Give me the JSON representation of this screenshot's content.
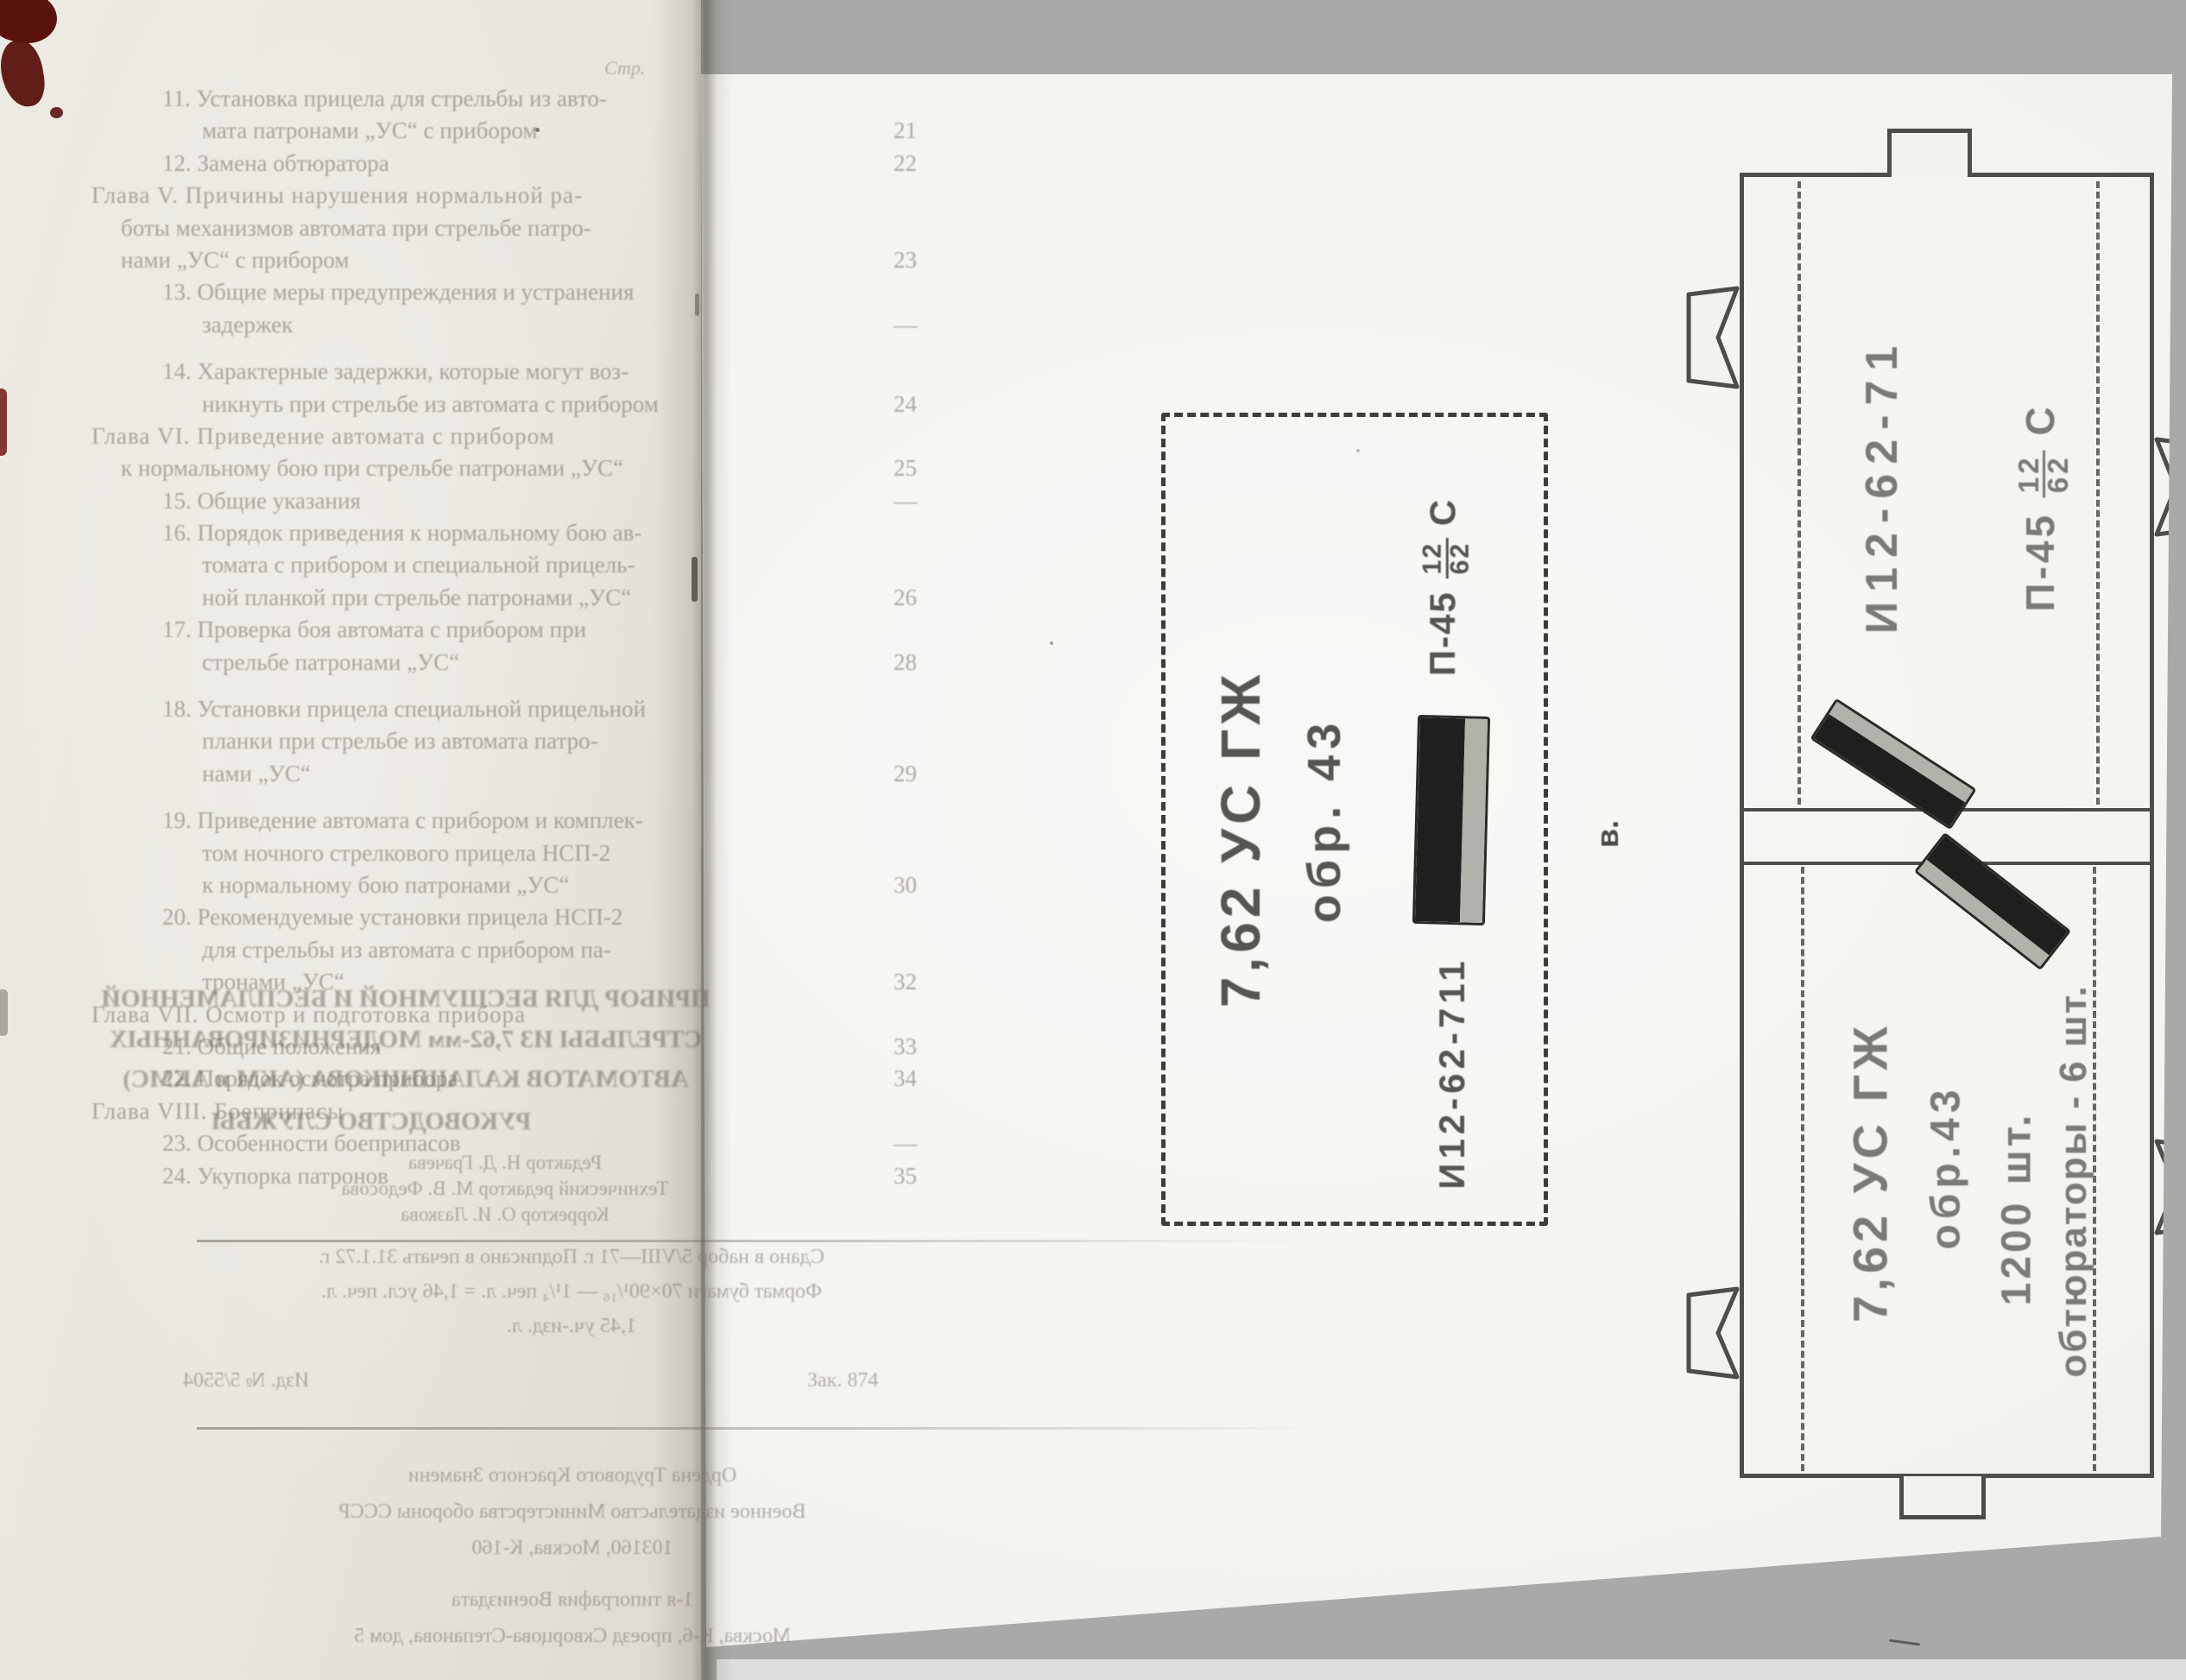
{
  "colors": {
    "scan_bg": "#a9a9a7",
    "paper_left": "#eae7e0",
    "paper_sheet": "#f3f2ee",
    "ink_line": "#4e4d49",
    "stamp_dark": "#565550",
    "stamp_gray": "#7b7a74",
    "band_black": "#201f1d",
    "band_stripe": "#b2b1aa",
    "toc_ink": "#7d766a",
    "stain_red": "#5a120c"
  },
  "left": {
    "header": "Стр.",
    "toc": [
      {
        "t": "11. Установка прицела для стрельбы из авто-",
        "r": "item"
      },
      {
        "t": "мата патронами „УС“ с прибором",
        "r": "cont",
        "p": "21"
      },
      {
        "t": "12. Замена обтюратора",
        "r": "item",
        "p": "22"
      },
      {
        "t": "Глава V. Причины нарушения нормальной ра-",
        "r": "chapter"
      },
      {
        "t": "боты механизмов автомата при стрельбе патро-",
        "r": "chapcont"
      },
      {
        "t": "нами „УС“ с прибором",
        "r": "chapcont",
        "p": "23"
      },
      {
        "t": "13. Общие меры предупреждения и устранения",
        "r": "item"
      },
      {
        "t": "задержек",
        "r": "cont",
        "p": "—"
      },
      {
        "t": "14. Характерные задержки, которые могут воз-",
        "r": "item",
        "g": "gap"
      },
      {
        "t": "никнуть при стрельбе из автомата с прибором",
        "r": "cont",
        "p": "24"
      },
      {
        "t": "Глава VI. Приведение автомата с прибором",
        "r": "chapter"
      },
      {
        "t": "к нормальному бою при стрельбе патронами „УС“",
        "r": "chapcont",
        "p": "25"
      },
      {
        "t": "15. Общие указания",
        "r": "item",
        "p": "—"
      },
      {
        "t": "16. Порядок приведения к нормальному бою ав-",
        "r": "item"
      },
      {
        "t": "томата с прибором и специальной прицель-",
        "r": "cont"
      },
      {
        "t": "ной планкой при стрельбе патронами „УС“",
        "r": "cont",
        "p": "26"
      },
      {
        "t": "17. Проверка боя автомата с прибором при",
        "r": "item"
      },
      {
        "t": "стрельбе патронами „УС“",
        "r": "cont",
        "p": "28"
      },
      {
        "t": "18. Установки прицела специальной прицельной",
        "r": "item",
        "g": "gap"
      },
      {
        "t": "планки при стрельбе из автомата патро-",
        "r": "cont"
      },
      {
        "t": "нами „УС“",
        "r": "cont",
        "p": "29"
      },
      {
        "t": "19. Приведение автомата с прибором и комплек-",
        "r": "item",
        "g": "gap"
      },
      {
        "t": "том ночного стрелкового прицела НСП-2",
        "r": "cont"
      },
      {
        "t": "к нормальному бою патронами „УС“",
        "r": "cont",
        "p": "30"
      },
      {
        "t": "20. Рекомендуемые установки прицела НСП-2",
        "r": "item"
      },
      {
        "t": "для стрельбы из автомата с прибором па-",
        "r": "cont"
      },
      {
        "t": "тронами „УС“",
        "r": "cont",
        "p": "32"
      },
      {
        "t": "Глава VII. Осмотр и подготовка прибора",
        "r": "chapter"
      },
      {
        "t": "21. Общие положения",
        "r": "item",
        "p": "33"
      },
      {
        "t": "22. Порядок осмотра прибора",
        "r": "item",
        "p": "34"
      },
      {
        "t": "Глава VIII. Боеприпасы",
        "r": "chapter"
      },
      {
        "t": "23. Особенности боеприпасов",
        "r": "item",
        "p": "—"
      },
      {
        "t": "24. Укупорка патронов",
        "r": "item",
        "p": "35"
      }
    ],
    "showthrough_title": [
      "ПРИБОР ДЛЯ БЕСШУМНОЙ И БЕСПЛАМЕННОЙ",
      "СТРЕЛЬБЫ ИЗ 7,62-мм МОДЕРНИЗИРОВАННЫХ",
      "АВТОМАТОВ КАЛАШНИКОВА (АКМ и АКМС)",
      "РУКОВОДСТВО СЛУЖБЫ"
    ],
    "editors": [
      "Редактор Н. Д. Грачева",
      "Технический редактор М. В. Федосова",
      "Корректор О. И. Лазкова"
    ],
    "imprint": [
      "Сдано в набор 5/VIII—71 г. Подписано в печать 31.1.72 г.",
      "Формат бумаги 70×90¹/₁₆ — 1¹/₄ печ. л. = 1,46 усл. печ. л.",
      "1,45 уч.-изд. л."
    ],
    "order_left": "Изд. № 5/5504",
    "order_right": "Зак. 874",
    "publisher": [
      "Ордена Трудового Красного Знамени",
      "Военное издательство Министерства обороны СССР",
      "103160, Москва, К-160",
      "1-я типография Воениздата",
      "Москва, К-6, проезд Скворцова-Степанова, дом 5"
    ]
  },
  "right": {
    "figure_letter": "в.",
    "label": {
      "caliber": "7,62 УС ГЖ",
      "model": "обр. 43",
      "lot": "И12-62-711",
      "powder_prefix": "П-45",
      "powder_num": "12",
      "powder_den": "62",
      "powder_suffix": "С"
    },
    "crate": {
      "lot": "И12-62-71",
      "powder_prefix": "П-45",
      "powder_num": "12",
      "powder_den": "62",
      "powder_suffix": "С",
      "caliber": "7,62 УС ГЖ",
      "model": "обр.43",
      "count": "1200 шт.",
      "obturators": "обтюраторы - 6 шт."
    }
  }
}
